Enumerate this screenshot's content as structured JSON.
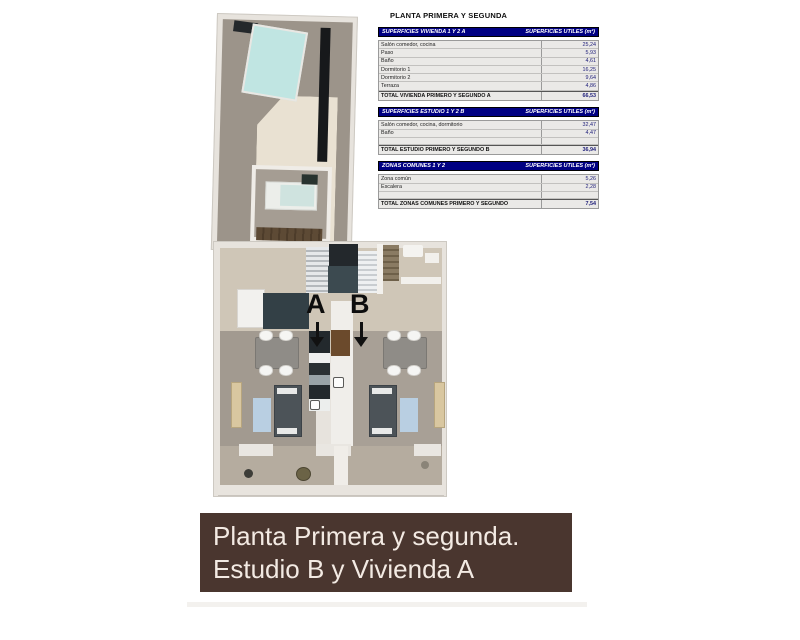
{
  "page_title": "PLANTA PRIMERA Y SEGUNDA",
  "tables": [
    {
      "header_left": "SUPERFICIES VIVIENDA 1 Y 2 A",
      "header_right": "SUPERFICIES UTILES  (m²)",
      "rows": [
        {
          "label": "Salón comedor, cocina",
          "value": "25,24"
        },
        {
          "label": "Paso",
          "value": "5,93"
        },
        {
          "label": "Baño",
          "value": "4,61"
        },
        {
          "label": "Dormitorio 1",
          "value": "16,25"
        },
        {
          "label": "Dormitorio 2",
          "value": "9,64"
        },
        {
          "label": "Terraza",
          "value": "4,86"
        }
      ],
      "total_label": "TOTAL VIVIENDA PRIMERO Y SEGUNDO A",
      "total_value": "66,53"
    },
    {
      "header_left": "SUPERFICIES ESTUDIO 1 Y 2 B",
      "header_right": "SUPERFICIES UTILES  (m²)",
      "rows": [
        {
          "label": "Salón comedor, cocina, dormitorio",
          "value": "32,47"
        },
        {
          "label": "Baño",
          "value": "4,47"
        }
      ],
      "total_label": "TOTAL ESTUDIO PRIMERO Y SEGUNDO B",
      "total_value": "36,94"
    },
    {
      "header_left": "ZONAS COMUNES 1 Y 2",
      "header_right": "SUPERFICIES UTILES  (m²)",
      "rows": [
        {
          "label": "Zona común",
          "value": "5,26"
        },
        {
          "label": "Escalera",
          "value": "2,28"
        }
      ],
      "total_label": "TOTAL ZONAS COMUNES PRIMERO Y SEGUNDO",
      "total_value": "7,54"
    }
  ],
  "plan": {
    "unit_a_label": "A",
    "unit_b_label": "B"
  },
  "banner": {
    "line1": "Planta Primera y segunda.",
    "line2": "Estudio B y Vivienda A"
  },
  "colors": {
    "table_header_bg": "#000082",
    "table_header_text": "#ffffff",
    "table_value_text": "#1c1c78",
    "banner_bg": "#4a362f",
    "banner_text": "#f3eae3",
    "floor_taupe": "#9c948a",
    "floor_cream_hall": "#cfc6b7",
    "floor_cream_room": "#e9e1d2",
    "floor_balcony": "#b5ac9f",
    "wall": "#e7e3dd",
    "accent_teal": "#c0e5e2",
    "rug_blue": "#b9cfe2",
    "dark_fixture": "#17191b"
  }
}
